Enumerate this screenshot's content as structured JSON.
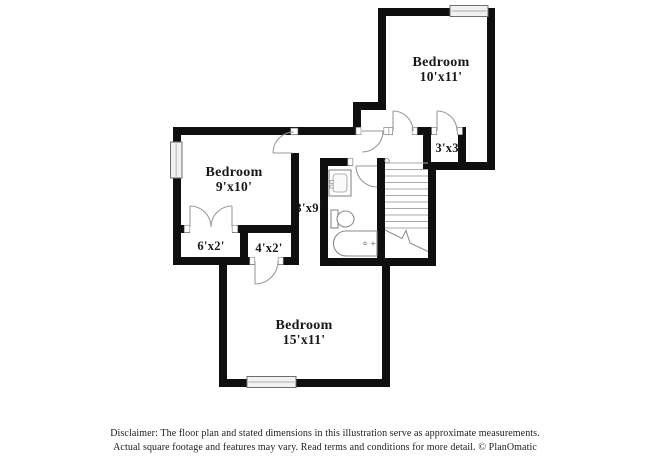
{
  "image": {
    "width": 650,
    "height": 473,
    "background": "#ffffff",
    "wall_color": "#0f0f0f",
    "door_line_color": "#9a9a9a",
    "label_color": "#181818"
  },
  "floor_plan": {
    "labels": {
      "bedroom10_name": "Bedroom",
      "bedroom10_dims": "10'x11'",
      "closet_3x3_dims": "3'x3'",
      "bedroom9_name": "Bedroom",
      "bedroom9_dims": "9'x10'",
      "hallway_dims": "3'x9'",
      "closet_6x2_dims": "6'x2'",
      "closet_4x2_dims": "4'x2'",
      "bedroom15_name": "Bedroom",
      "bedroom15_dims": "15'x11'"
    },
    "fixtures": [
      "sink-vanity",
      "toilet",
      "bathtub",
      "staircase"
    ],
    "features": [
      "windows",
      "door-swings",
      "closets"
    ]
  },
  "disclaimer": {
    "line1": "Disclaimer: The floor plan and stated dimensions in this illustration serve as approximate measurements.",
    "line2": "Actual square footage and features may vary. Read terms and conditions for more detail. © PlanOmatic"
  }
}
